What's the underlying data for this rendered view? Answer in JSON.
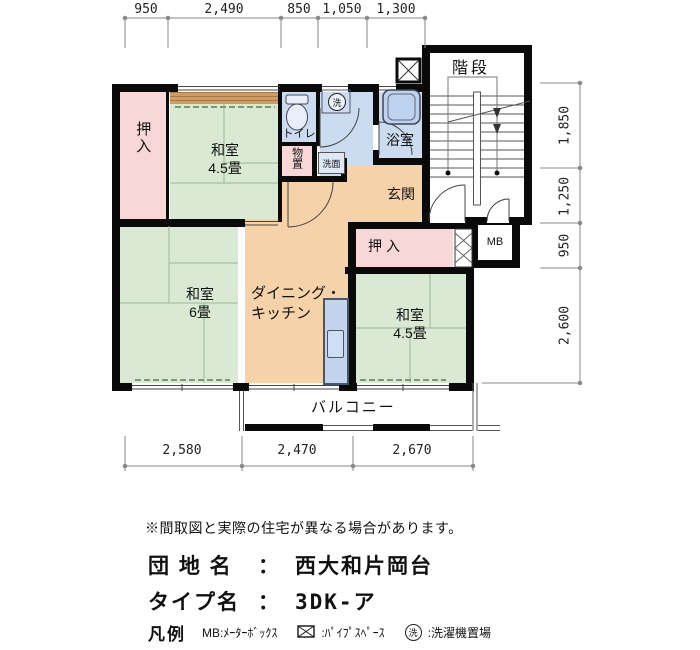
{
  "plan": {
    "dims_top": [
      "950",
      "2,490",
      "850",
      "1,050",
      "1,300"
    ],
    "dims_right": [
      "1,850",
      "1,250",
      "950",
      "2,600"
    ],
    "dims_bottom": [
      "2,580",
      "2,470",
      "2,670"
    ],
    "rooms": {
      "oshiire_top": "押入",
      "washitsu45_top_name": "和室",
      "washitsu45_top_size": "4.5畳",
      "toilet": "トイレ",
      "monooki": "物置",
      "senmen": "洗面",
      "bath": "浴室",
      "genkan": "玄関",
      "kaidan": "階段",
      "oshiire_mid": "押入",
      "mb": "MB",
      "washitsu6_name": "和室",
      "washitsu6_size": "6畳",
      "dk_line1": "ダイニング・",
      "dk_line2": "キッチン",
      "washitsu45_b_name": "和室",
      "washitsu45_b_size": "4.5畳",
      "balcony": "バルコニー",
      "laundry_symbol": "洗"
    },
    "colors": {
      "tatami_green": "#d9e9d4",
      "closet_pink": "#f8d7d7",
      "wet_blue": "#cbdbf0",
      "dk_peach": "#f6d2a9",
      "wood_tan": "#cf9d63",
      "wall_black": "#0a0a0a"
    }
  },
  "footer": {
    "note": "※間取図と実際の住宅が異なる場合があります。",
    "estate_label": "団 地 名",
    "estate_colon": "：",
    "estate_value": "西大和片岡台",
    "type_label": "タイプ名",
    "type_colon": "：",
    "type_value": "3DK-ア",
    "legend_title": "凡例",
    "legend_mb": "MB:ﾒｰﾀｰﾎﾞｯｸｽ",
    "legend_ps_label": ":ﾊﾟｲﾌﾟｽﾍﾟｰｽ",
    "legend_laundry_symbol": "洗",
    "legend_laundry_label": ":洗濯機置場"
  }
}
